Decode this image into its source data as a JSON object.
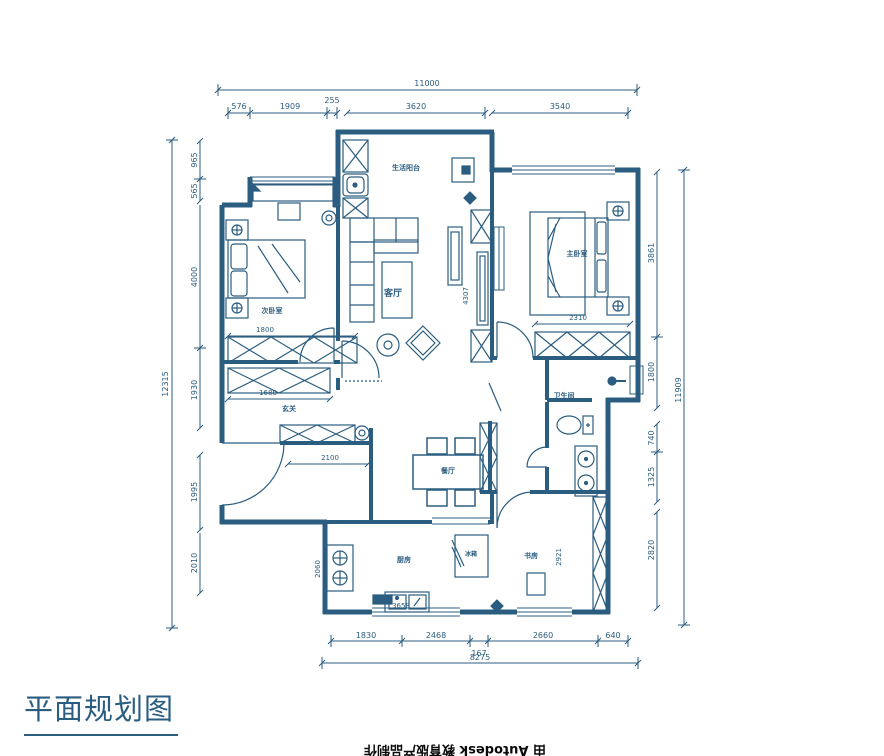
{
  "title": {
    "text": "平面规划图"
  },
  "watermark": {
    "text": "由 Autodesk 教育版产品制作"
  },
  "colors": {
    "ink": "#2b5d80",
    "watermark": "#0a0a0a",
    "background": "#ffffff"
  },
  "rooms": {
    "balcony": "生活阳台",
    "living": "客厅",
    "master": "主卧室",
    "bedroom2": "次卧室",
    "hall": "玄关",
    "dining": "餐厅",
    "kitchen": "厨房",
    "study": "书房",
    "bath": "卫生间",
    "fridge": "冰箱"
  },
  "dims": {
    "top": {
      "total": "11000",
      "segs": [
        "576",
        "1909",
        "255",
        "3620",
        "3540"
      ]
    },
    "left": {
      "total": "12315",
      "segs": [
        "965",
        "565",
        "4000",
        "1930",
        "1995",
        "2010"
      ]
    },
    "right": {
      "total": "11909",
      "segs": [
        "3861",
        "1800",
        "740",
        "1325",
        "2820"
      ]
    },
    "bottom": {
      "total": "8275",
      "segs": [
        "1830",
        "2468",
        "167",
        "2660",
        "640"
      ]
    },
    "inner": {
      "bed2_wardrobe": "1800",
      "hall_closet": "1680",
      "hall_width": "2100",
      "living_height": "4307",
      "master_wardrobe": "2310",
      "kitchen_width": "3658",
      "kitchen_depth": "2060",
      "study_height": "2921"
    }
  }
}
